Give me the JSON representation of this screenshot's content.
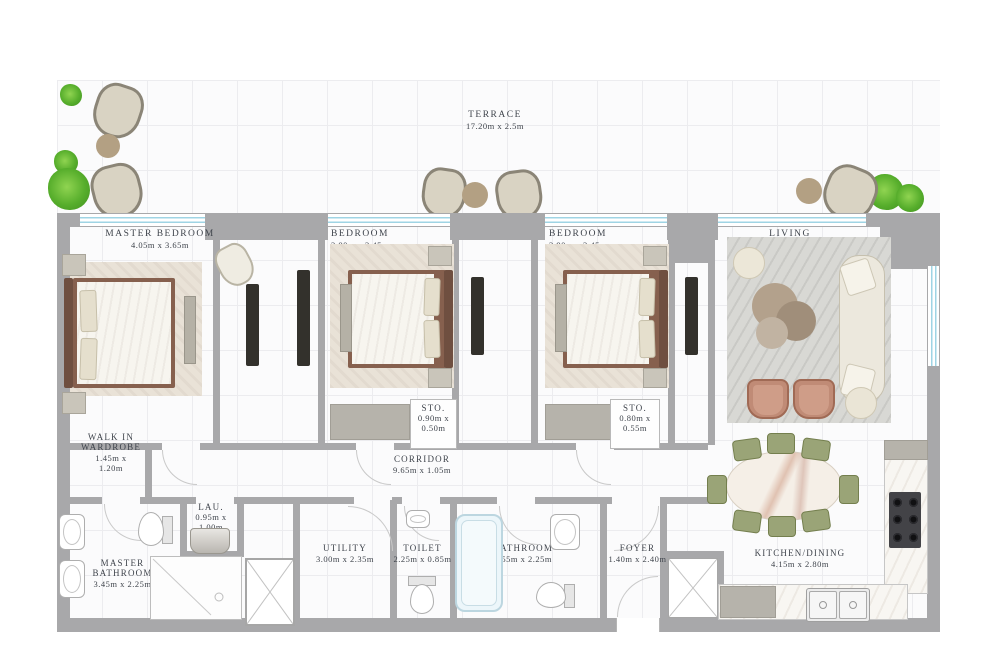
{
  "rooms": {
    "terrace": {
      "name": "TERRACE",
      "dims": "17.20m x 2.5m"
    },
    "master_bedroom": {
      "name": "MASTER BEDROOM",
      "dims": "4.05m x 3.65m"
    },
    "bedroom_2": {
      "name": "BEDROOM",
      "dims": "3.80m x 3.45m"
    },
    "bedroom_3": {
      "name": "BEDROOM",
      "dims": "3.90m x 3.45m"
    },
    "living": {
      "name": "LIVING",
      "dims": "4.80m x 4.20m"
    },
    "walk_in_wardrobe": {
      "name": "WALK IN WARDROBE",
      "dims": "1.45m x 1.20m"
    },
    "corridor": {
      "name": "CORRIDOR",
      "dims": "9.65m x 1.05m"
    },
    "storage_1": {
      "name": "STO.",
      "dims": "0.90m x 0.50m"
    },
    "storage_2": {
      "name": "STO.",
      "dims": "0.80m x 0.55m"
    },
    "laundry": {
      "name": "LAU.",
      "dims": "0.95m x 1.00m"
    },
    "master_bathroom": {
      "name": "MASTER BATHROOM",
      "dims": "3.45m x 2.25m"
    },
    "utility": {
      "name": "UTILITY",
      "dims": "3.00m x 2.35m"
    },
    "toilet": {
      "name": "TOILET",
      "dims": "2.25m x 0.85m"
    },
    "bathroom": {
      "name": "BATHROOM",
      "dims": "2.55m x 2.25m"
    },
    "foyer": {
      "name": "FOYER",
      "dims": "1.40m x 2.40m"
    },
    "kitchen_dining": {
      "name": "KITCHEN/DINING",
      "dims": "4.15m x 2.80m"
    }
  },
  "colors": {
    "wall": "#a8a8aa",
    "window": "#9fd4e4",
    "label_text": "#3f444c",
    "plant_green": "#57ae2c",
    "wood": "#86604e",
    "dining_chair": "#9aa477",
    "armchair": "#c08b76"
  }
}
